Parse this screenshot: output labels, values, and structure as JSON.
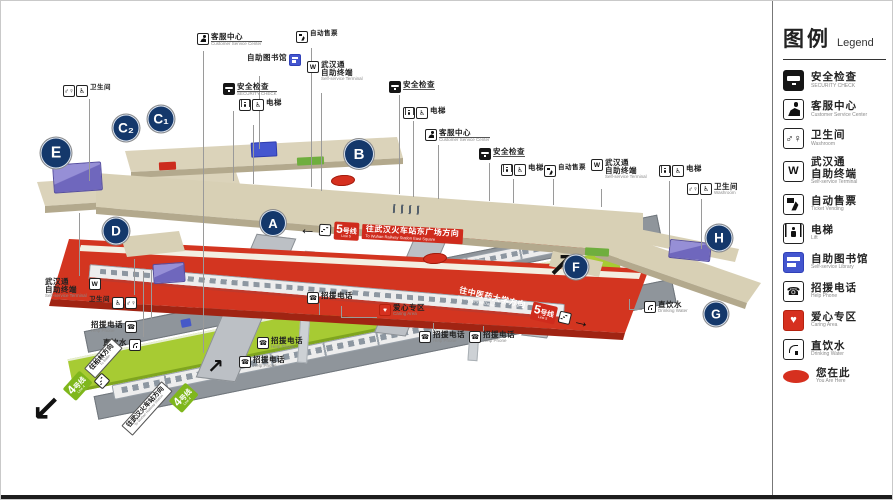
{
  "legend": {
    "title_zh": "图例",
    "title_en": "Legend",
    "items": [
      {
        "id": "security",
        "zh": "安全检查",
        "en": "SECURITY CHECK"
      },
      {
        "id": "service",
        "zh": "客服中心",
        "en": "Customer Service Center"
      },
      {
        "id": "washroom",
        "zh": "卫生间",
        "en": "Washroom"
      },
      {
        "id": "wuhantong",
        "zh": "武汉通",
        "zh2": "自助终端",
        "en": "Self-service Terminal"
      },
      {
        "id": "tvm",
        "zh": "自动售票",
        "en": "Ticket Vending"
      },
      {
        "id": "lift",
        "zh": "电梯",
        "en": "Lift"
      },
      {
        "id": "library",
        "zh": "自助图书馆",
        "en": "Self-service Library"
      },
      {
        "id": "helpphone",
        "zh": "招援电话",
        "en": "Help Phone"
      },
      {
        "id": "care",
        "zh": "爱心专区",
        "en": "Caring Area"
      },
      {
        "id": "water",
        "zh": "直饮水",
        "en": "Drinking Water"
      },
      {
        "id": "here",
        "zh": "您在此",
        "en": "You Are Here"
      }
    ]
  },
  "entrances": [
    {
      "label": "A",
      "x": 272,
      "y": 222,
      "size": 26
    },
    {
      "label": "B",
      "x": 358,
      "y": 153,
      "size": 30
    },
    {
      "label": "C₁",
      "x": 160,
      "y": 118,
      "size": 27
    },
    {
      "label": "C₂",
      "x": 125,
      "y": 127,
      "size": 27
    },
    {
      "label": "D",
      "x": 115,
      "y": 230,
      "size": 27
    },
    {
      "label": "E",
      "x": 55,
      "y": 152,
      "size": 31
    },
    {
      "label": "F",
      "x": 575,
      "y": 266,
      "size": 25
    },
    {
      "label": "G",
      "x": 715,
      "y": 313,
      "size": 25
    },
    {
      "label": "H",
      "x": 718,
      "y": 237,
      "size": 27
    }
  ],
  "signs": {
    "line5_box_zh": "5号线",
    "line5_box_en": "Line 5",
    "line5_dir1_zh": "往武汉火车站东广场方向",
    "line5_dir1_en": "To Wuhan Railway Station East Square",
    "line5_dir2_zh": "往中医药大学方向",
    "line5_dir2_en": "To Zhongyiyao Daxue",
    "line4_box_zh": "4号线",
    "line4_box_en": "Line 4",
    "line4_dir1_zh": "往柏林方向",
    "line4_dir1_en": "To Bailin",
    "line4_dir2_zh": "往武汉火车站方向",
    "line4_dir2_en": "To Wuhan Railway Station"
  },
  "glyphs": {
    "sw": "↙",
    "ne": "↗",
    "ne_small": "↗",
    "left": "←",
    "right": "→"
  },
  "markers": {
    "you_are_here": [
      {
        "x": 330,
        "y": 174
      },
      {
        "x": 422,
        "y": 252
      }
    ]
  },
  "callouts": [
    {
      "x": 62,
      "y": 84,
      "icons": [
        "washroom",
        "wheelchair"
      ],
      "zh": "卫生间",
      "small": true
    },
    {
      "x": 196,
      "y": 32,
      "icons": [
        "service"
      ],
      "zh": "客服中心",
      "en": "Customer Service Center",
      "u": true
    },
    {
      "x": 246,
      "y": 53,
      "icons": [
        "library"
      ],
      "zh": "自助图书馆",
      "icon_side": "right"
    },
    {
      "x": 295,
      "y": 30,
      "icons": [
        "tvm"
      ],
      "zh": "自动售票",
      "small": true
    },
    {
      "x": 306,
      "y": 60,
      "icons": [
        "wuhantong"
      ],
      "zh": "武汉通",
      "zh2": "自助终端",
      "en": "Self-service Terminal"
    },
    {
      "x": 222,
      "y": 82,
      "icons": [
        "security"
      ],
      "zh": "安全检查",
      "en": "SECURITY CHECK",
      "u": true
    },
    {
      "x": 238,
      "y": 98,
      "icons": [
        "lift",
        "wheelchair"
      ],
      "zh": "电梯"
    },
    {
      "x": 388,
      "y": 80,
      "icons": [
        "security"
      ],
      "zh": "安全检查",
      "u": true
    },
    {
      "x": 402,
      "y": 106,
      "icons": [
        "lift",
        "wheelchair"
      ],
      "zh": "电梯"
    },
    {
      "x": 424,
      "y": 128,
      "icons": [
        "service"
      ],
      "zh": "客服中心",
      "en": "Customer Service Center",
      "u": true
    },
    {
      "x": 478,
      "y": 147,
      "icons": [
        "security"
      ],
      "zh": "安全检查",
      "u": true
    },
    {
      "x": 500,
      "y": 163,
      "icons": [
        "lift",
        "wheelchair"
      ],
      "zh": "电梯"
    },
    {
      "x": 543,
      "y": 164,
      "icons": [
        "tvm"
      ],
      "zh": "自动售票",
      "small": true
    },
    {
      "x": 590,
      "y": 158,
      "icons": [
        "wuhantong"
      ],
      "zh": "武汉通",
      "zh2": "自助终端",
      "en": "Self-service Terminal"
    },
    {
      "x": 658,
      "y": 164,
      "icons": [
        "lift",
        "wheelchair"
      ],
      "zh": "电梯"
    },
    {
      "x": 686,
      "y": 182,
      "icons": [
        "washroom",
        "wheelchair"
      ],
      "zh": "卫生间",
      "en": "Washroom"
    },
    {
      "x": 44,
      "y": 277,
      "icons": [
        "wuhantong"
      ],
      "zh": "武汉通",
      "zh2": "自助终端",
      "en": "Self-service Terminal",
      "icon_side": "right"
    },
    {
      "x": 88,
      "y": 296,
      "icons": [
        "wheelchair",
        "washroom"
      ],
      "zh": "卫生间",
      "icon_side": "right",
      "small": true
    },
    {
      "x": 90,
      "y": 320,
      "icons": [
        "helpphone"
      ],
      "zh": "招援电话",
      "en": "Help Phone",
      "icon_side": "right"
    },
    {
      "x": 102,
      "y": 338,
      "icons": [
        "water"
      ],
      "zh": "直饮水",
      "icon_side": "right"
    },
    {
      "x": 306,
      "y": 291,
      "icons": [
        "helpphone"
      ],
      "zh": "招援电话"
    },
    {
      "x": 256,
      "y": 336,
      "icons": [
        "helpphone"
      ],
      "zh": "招援电话",
      "en": "Help Phone"
    },
    {
      "x": 238,
      "y": 355,
      "icons": [
        "helpphone"
      ],
      "zh": "招援电话",
      "en": "Help Phone"
    },
    {
      "x": 378,
      "y": 303,
      "icons": [
        "care"
      ],
      "zh": "爱心专区",
      "en": "Caring Area"
    },
    {
      "x": 418,
      "y": 330,
      "icons": [
        "helpphone"
      ],
      "zh": "招援电话",
      "en": "Help Phone"
    },
    {
      "x": 468,
      "y": 330,
      "icons": [
        "helpphone"
      ],
      "zh": "招援电话",
      "en": "Help Phone"
    },
    {
      "x": 643,
      "y": 300,
      "icons": [
        "water"
      ],
      "zh": "直饮水",
      "en": "Drinking Water"
    }
  ]
}
